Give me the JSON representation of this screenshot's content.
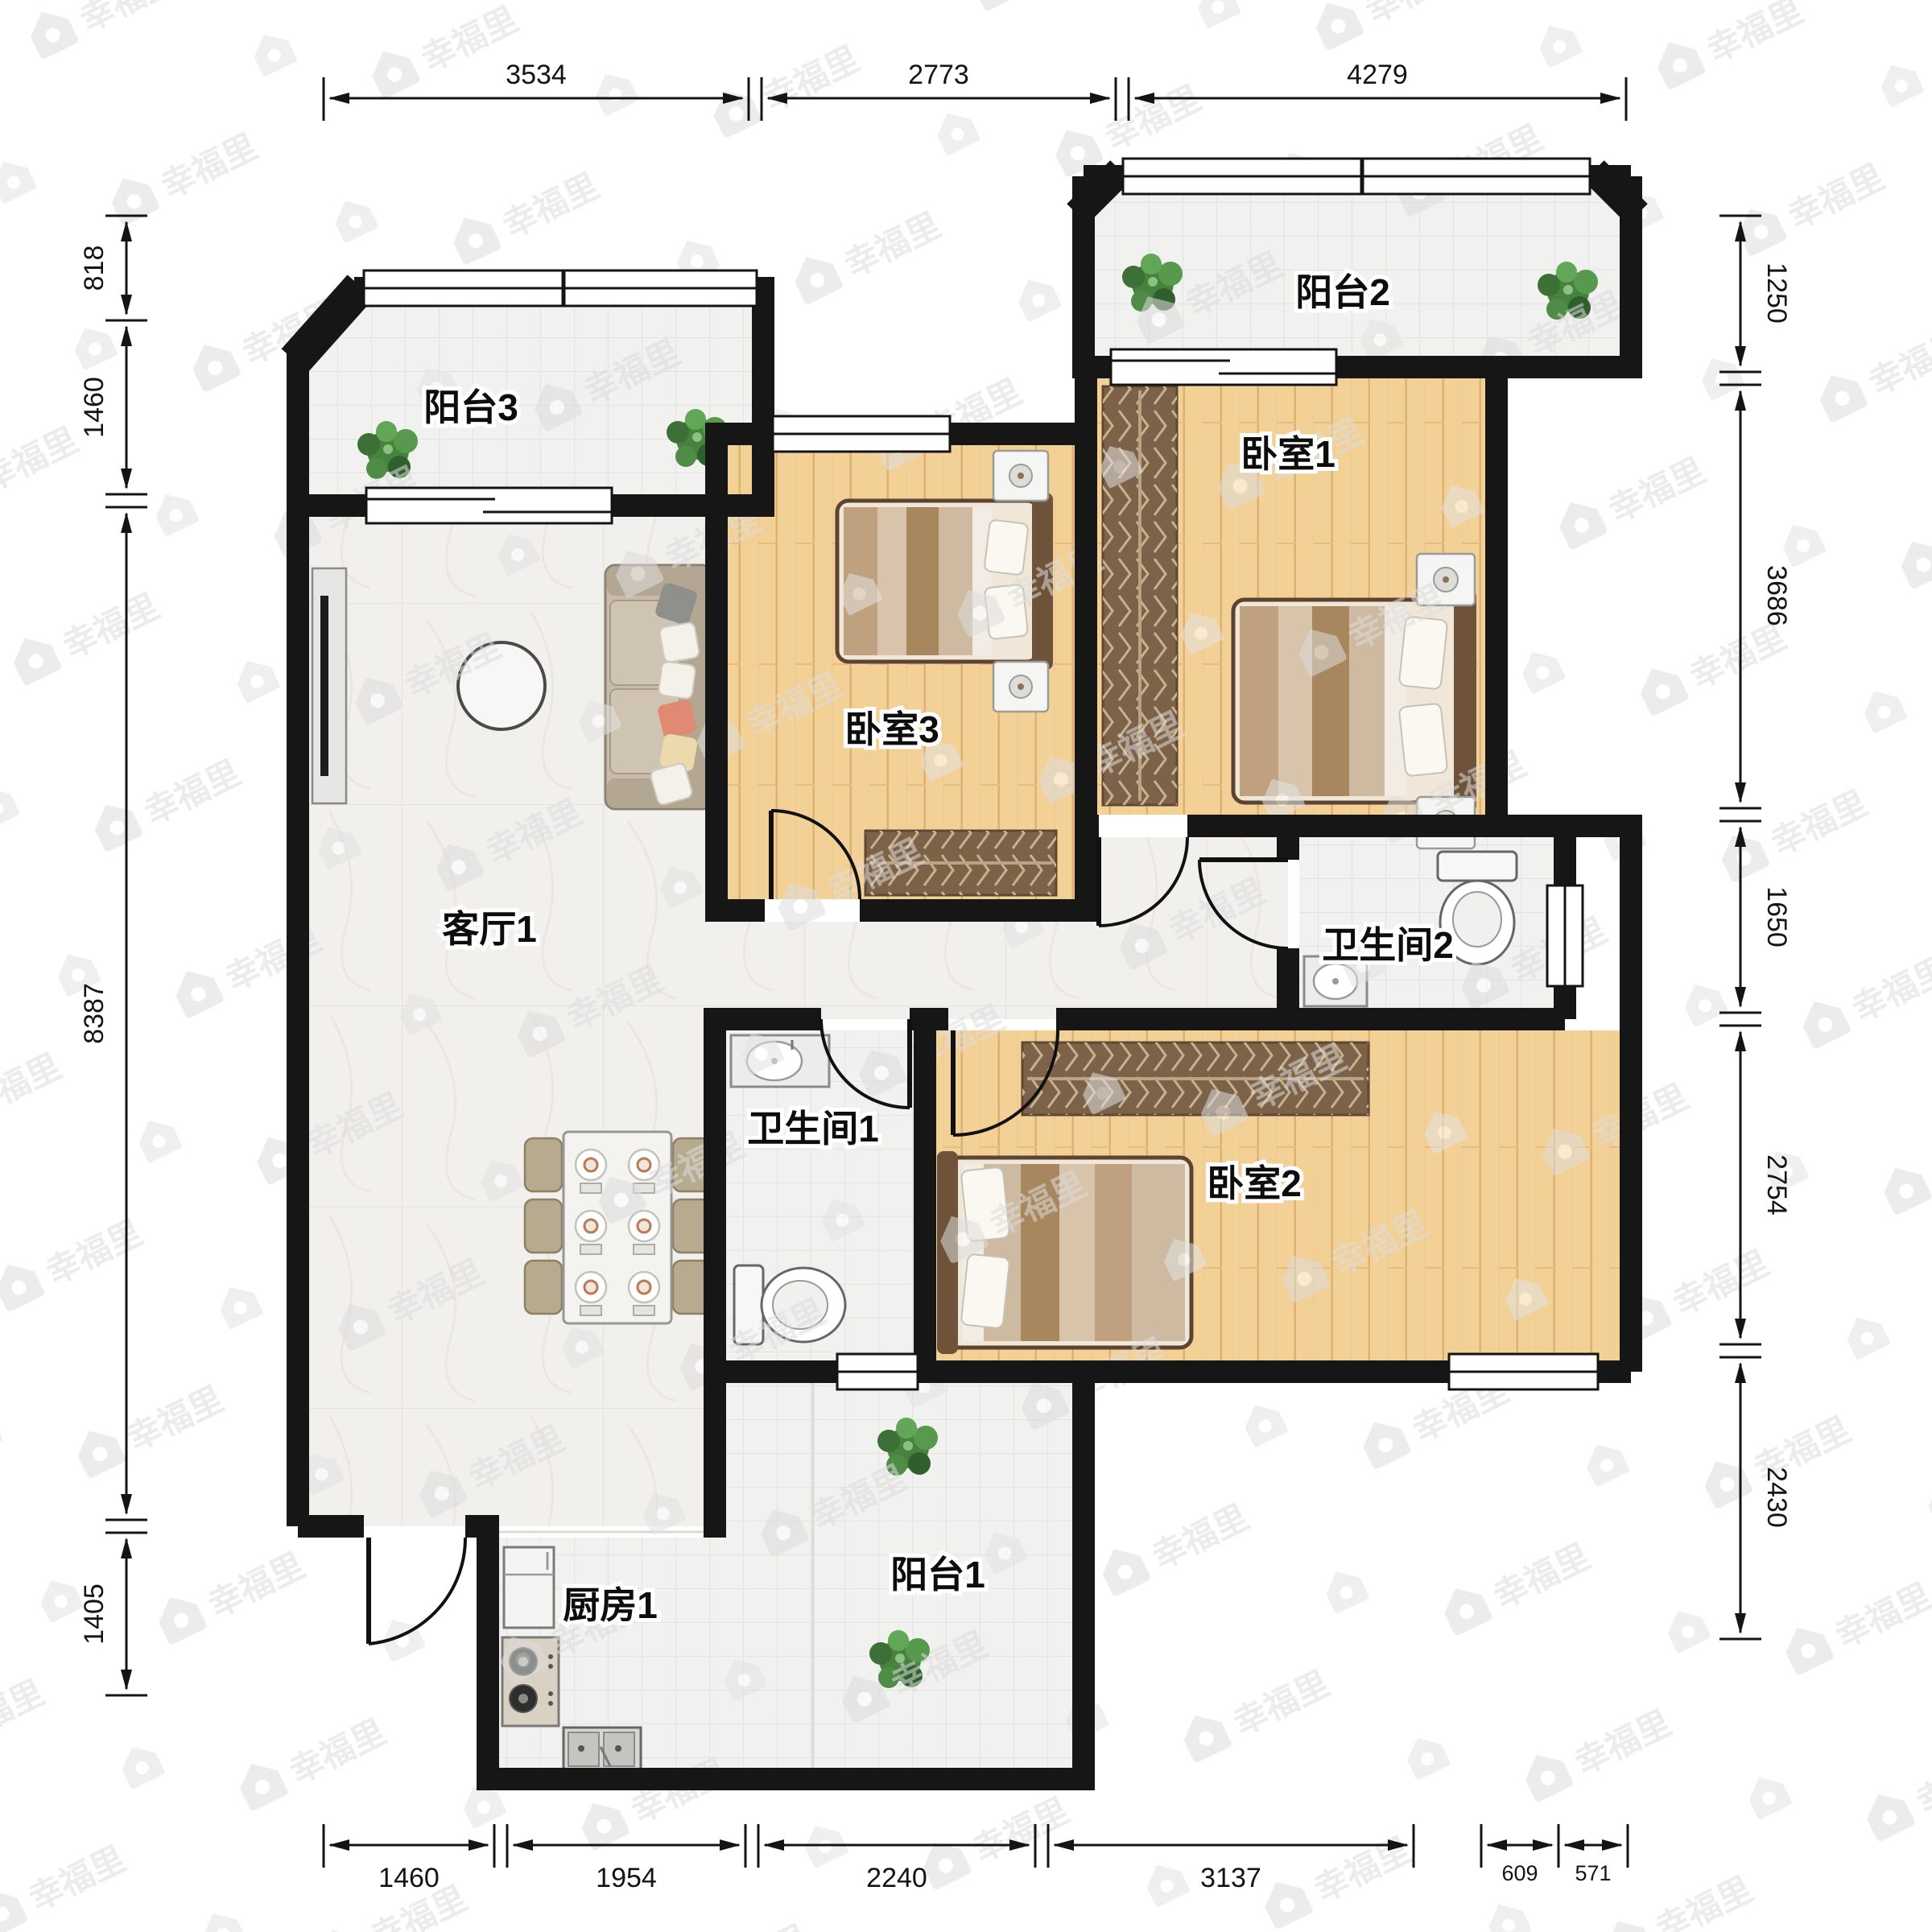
{
  "watermark": {
    "brand": "幸福里",
    "icon": "house-icon",
    "color": "#dcdcdc"
  },
  "rooms": [
    {
      "id": "balcony3",
      "label": "阳台3"
    },
    {
      "id": "balcony2",
      "label": "阳台2"
    },
    {
      "id": "bedroom1",
      "label": "卧室1"
    },
    {
      "id": "bedroom3",
      "label": "卧室3"
    },
    {
      "id": "living",
      "label": "客厅1"
    },
    {
      "id": "bath2",
      "label": "卫生间2"
    },
    {
      "id": "bath1",
      "label": "卫生间1"
    },
    {
      "id": "bedroom2",
      "label": "卧室2"
    },
    {
      "id": "kitchen",
      "label": "厨房1"
    },
    {
      "id": "balcony1",
      "label": "阳台1"
    }
  ],
  "dimensions": {
    "top": [
      "3534",
      "2773",
      "4279"
    ],
    "bottom": [
      "1460",
      "1954",
      "2240",
      "3137",
      "609",
      "571"
    ],
    "left": [
      "818",
      "1460",
      "8387",
      "1405"
    ],
    "right": [
      "1250",
      "3686",
      "1650",
      "2754",
      "2430"
    ]
  },
  "colors": {
    "wall": "#161616",
    "wood_floor": "#f3d096",
    "tile_floor": "#f1f1ef",
    "marble_floor": "#f2f0ec",
    "dimension": "#1a1a1a"
  }
}
